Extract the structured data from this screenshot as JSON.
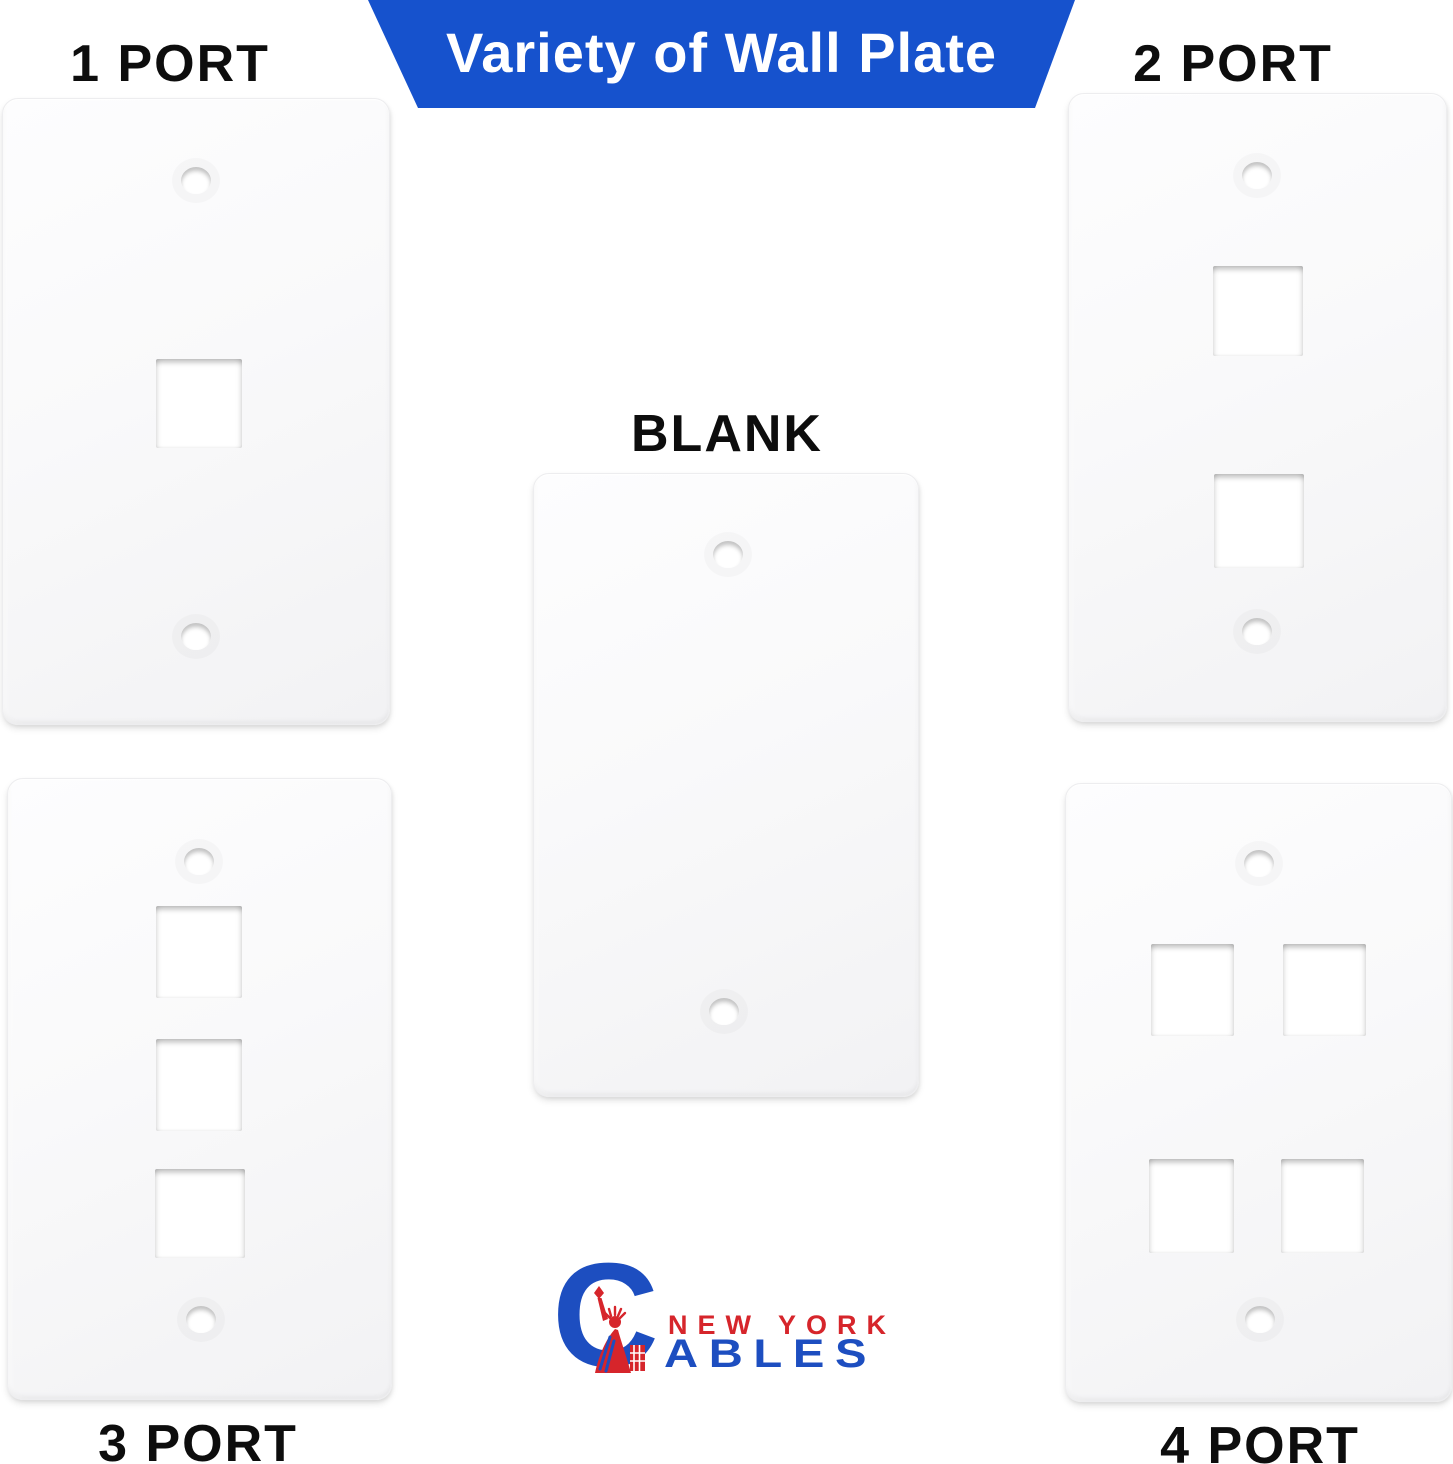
{
  "banner": {
    "text": "Variety of Wall Plate",
    "bg_color": "#1652cd",
    "text_color": "#ffffff"
  },
  "plates": [
    {
      "id": "plate-1-port",
      "label": "1 PORT",
      "ports": 1,
      "position": "top-left"
    },
    {
      "id": "plate-2-port",
      "label": "2 PORT",
      "ports": 2,
      "position": "top-right"
    },
    {
      "id": "plate-blank",
      "label": "BLANK",
      "ports": 0,
      "position": "center"
    },
    {
      "id": "plate-3-port",
      "label": "3 PORT",
      "ports": 3,
      "position": "bottom-left"
    },
    {
      "id": "plate-4-port",
      "label": "4 PORT",
      "ports": 4,
      "position": "bottom-right"
    }
  ],
  "logo": {
    "brand_initial": "C",
    "line1": "NEW YORK",
    "line2": "ABLES",
    "red": "#d6252b",
    "blue": "#1d4ec0"
  },
  "colors": {
    "background": "#ffffff",
    "plate": "#f8f8f9",
    "label_text": "#0d0d0d"
  }
}
